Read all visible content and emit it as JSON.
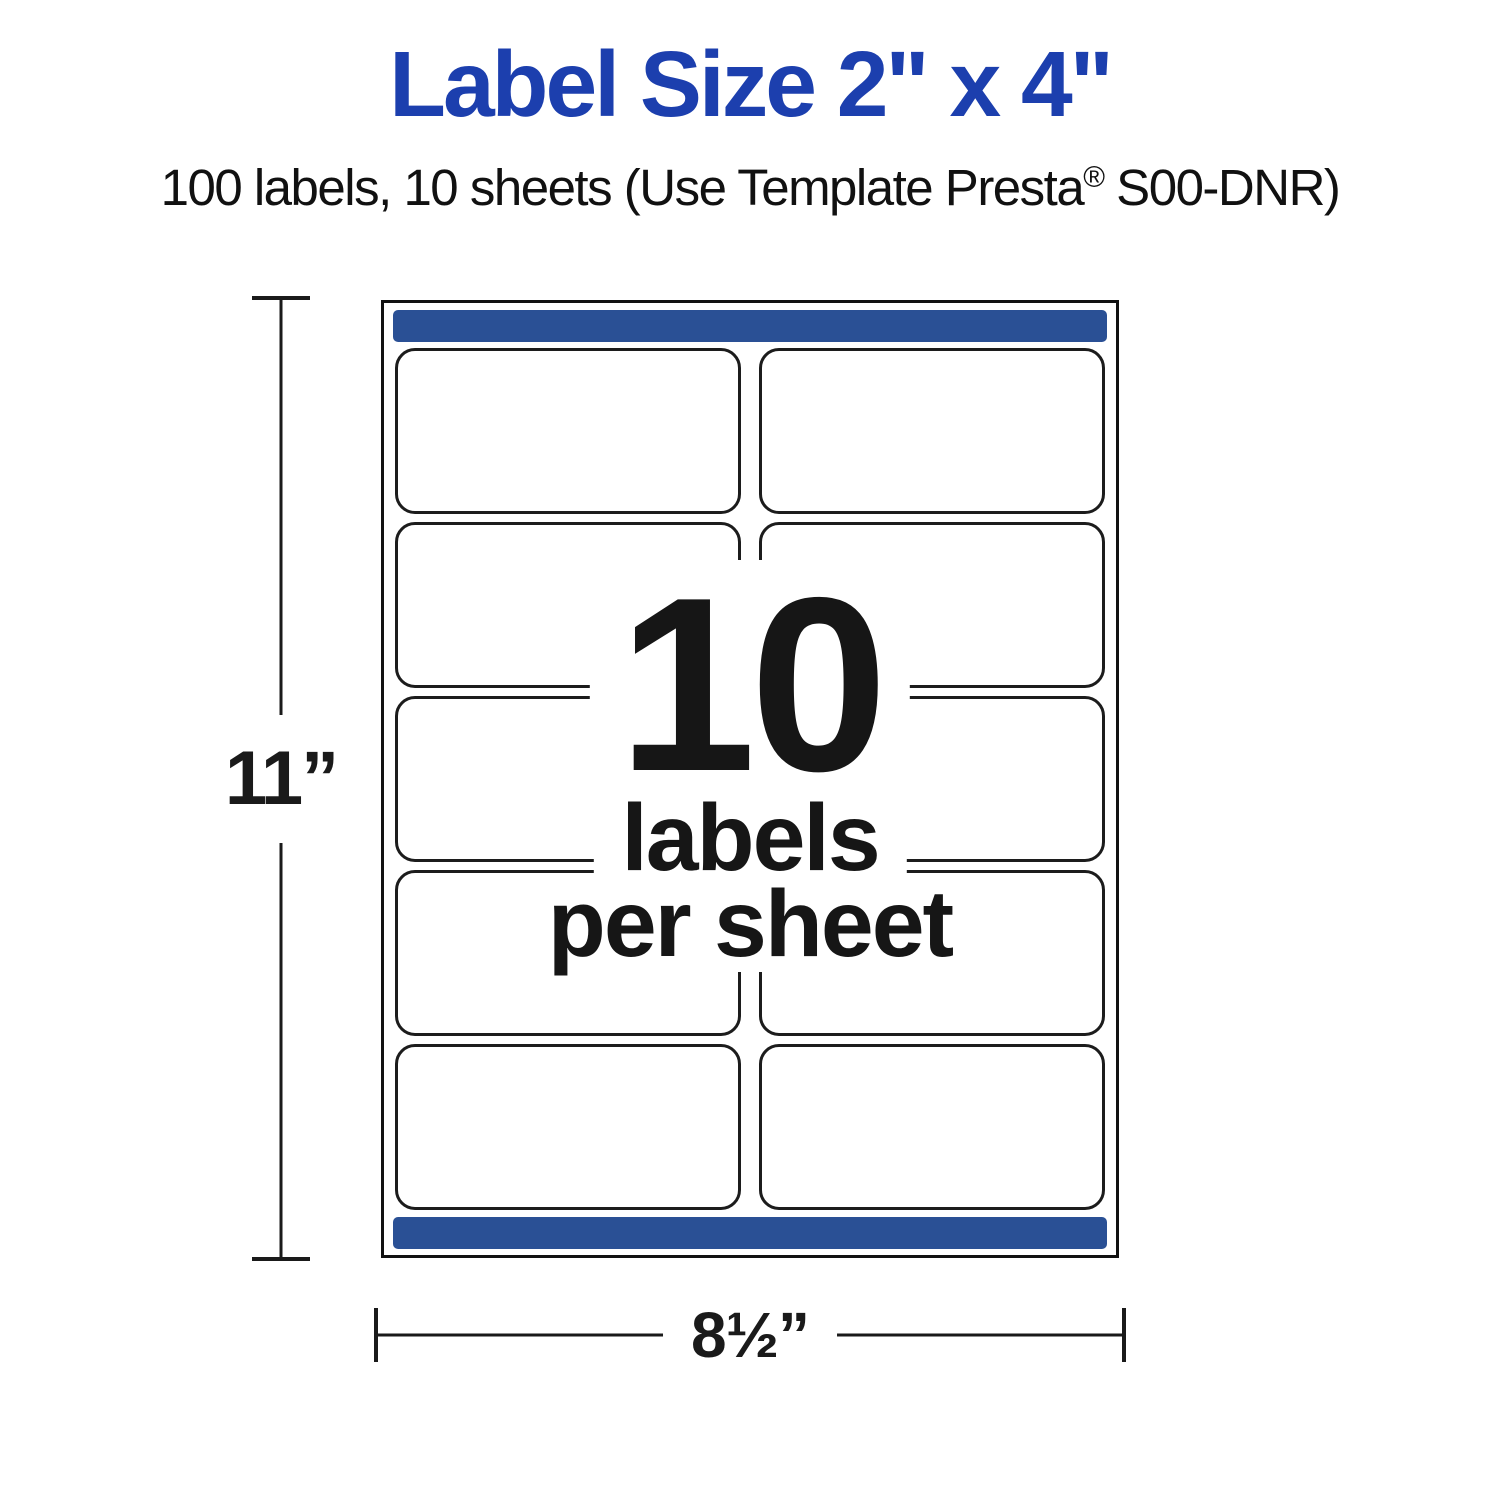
{
  "colors": {
    "title_blue": "#1c3fae",
    "bar_blue": "#2a5095",
    "ink": "#1a1a1a"
  },
  "header": {
    "title": "Label Size 2\" x 4\"",
    "subtitle_before_reg": "100 labels, 10 sheets (Use Template Presta",
    "subtitle_reg": "®",
    "subtitle_after_reg": " S00-DNR)"
  },
  "sheet": {
    "rows": 5,
    "cols": 2,
    "labels_total": 10,
    "overlay": {
      "count": "10",
      "unit_line1": "labels",
      "unit_line2": "per sheet"
    }
  },
  "dimensions": {
    "height": "11”",
    "width": "8½”"
  }
}
